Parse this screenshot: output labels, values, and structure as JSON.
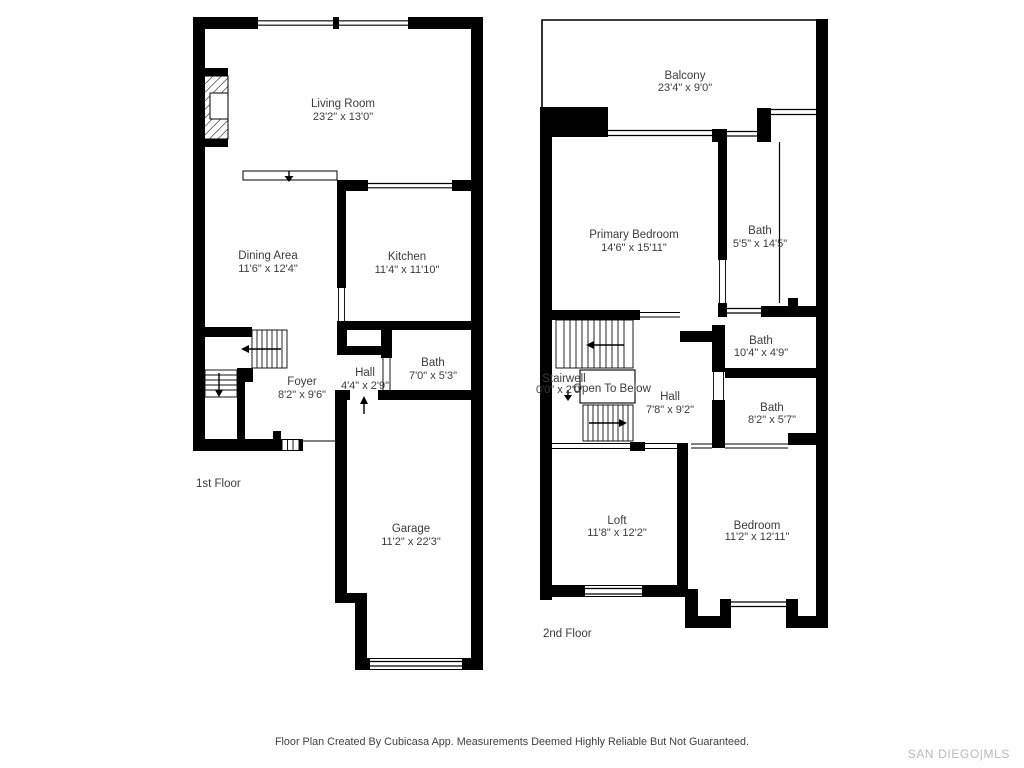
{
  "colors": {
    "wall": "#000000",
    "text": "#3c3c3c",
    "watermark": "#b9b9b9"
  },
  "floors": {
    "first": {
      "label": "1st Floor",
      "rooms": {
        "living_room": {
          "name": "Living Room",
          "dims": "23'2\" x 13'0\""
        },
        "dining_area": {
          "name": "Dining Area",
          "dims": "11'6\" x 12'4\""
        },
        "kitchen": {
          "name": "Kitchen",
          "dims": "11'4\" x 11'10\""
        },
        "foyer": {
          "name": "Foyer",
          "dims": "8'2\" x 9'6\""
        },
        "hall": {
          "name": "Hall",
          "dims": "4'4\" x 2'9\""
        },
        "bath": {
          "name": "Bath",
          "dims": "7'0\" x 5'3\""
        },
        "garage": {
          "name": "Garage",
          "dims": "11'2\" x 22'3\""
        }
      }
    },
    "second": {
      "label": "2nd Floor",
      "rooms": {
        "balcony": {
          "name": "Balcony",
          "dims": "23'4\" x 9'0\""
        },
        "primary_bedroom": {
          "name": "Primary Bedroom",
          "dims": "14'6\" x 15'11\""
        },
        "bath_top": {
          "name": "Bath",
          "dims": "5'5\" x 14'5\""
        },
        "stairwell": {
          "name": "Stairwell",
          "dims": "0'0\" x 2'0\""
        },
        "open_to_below": {
          "name": "Open To Below"
        },
        "hall": {
          "name": "Hall",
          "dims": "7'8\" x 9'2\""
        },
        "bath_middle": {
          "name": "Bath",
          "dims": "10'4\" x 4'9\""
        },
        "bath_lower": {
          "name": "Bath",
          "dims": "8'2\" x 5'7\""
        },
        "loft": {
          "name": "Loft",
          "dims": "11'8\" x 12'2\""
        },
        "bedroom": {
          "name": "Bedroom",
          "dims": "11'2\" x 12'11\""
        }
      }
    }
  },
  "footer": {
    "disclaimer": "Floor Plan Created By Cubicasa App. Measurements Deemed Highly Reliable But Not Guaranteed.",
    "watermark": "SAN DIEGO|MLS"
  }
}
